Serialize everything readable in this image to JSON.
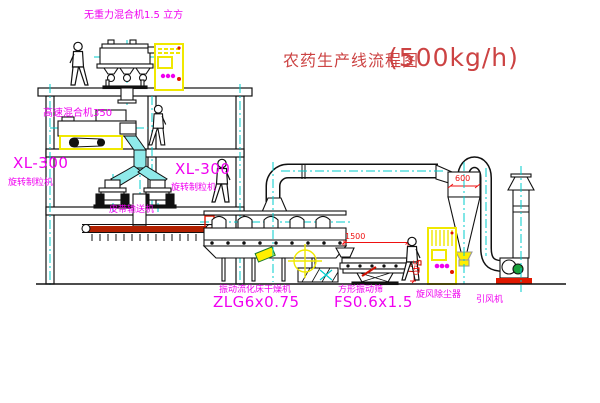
{
  "title": {
    "text": "农药生产线流程图",
    "capacity": "(500kg/h)"
  },
  "equipment": {
    "top_mixer": "无重力混合机1.5 立方",
    "highspeed_mixer": "高速混合机350",
    "granulator_left": {
      "model": "XL-300",
      "name": "旋转制粒机"
    },
    "granulator_right": {
      "model": "XL-300",
      "name": "旋转制粒机"
    },
    "belt_conveyor": "皮带输送机",
    "dryer": {
      "name": "振动流化床干燥机",
      "model": "ZLG6x0.75"
    },
    "sieve": {
      "name": "方形振动筛",
      "model": "FS0.6x1.5"
    },
    "cyclone": "旋风除尘器",
    "fan": "引风机"
  },
  "dimensions": {
    "sieve_length": "1500",
    "sieve_height": "540",
    "cyclone_diameter": "600"
  },
  "colors": {
    "label_magenta": "#f000f0",
    "title_red": "#cc4343",
    "dimension_red": "#ee1111",
    "centerline_cyan": "#00cdcd",
    "highlight_yellow": "#ffef00"
  }
}
